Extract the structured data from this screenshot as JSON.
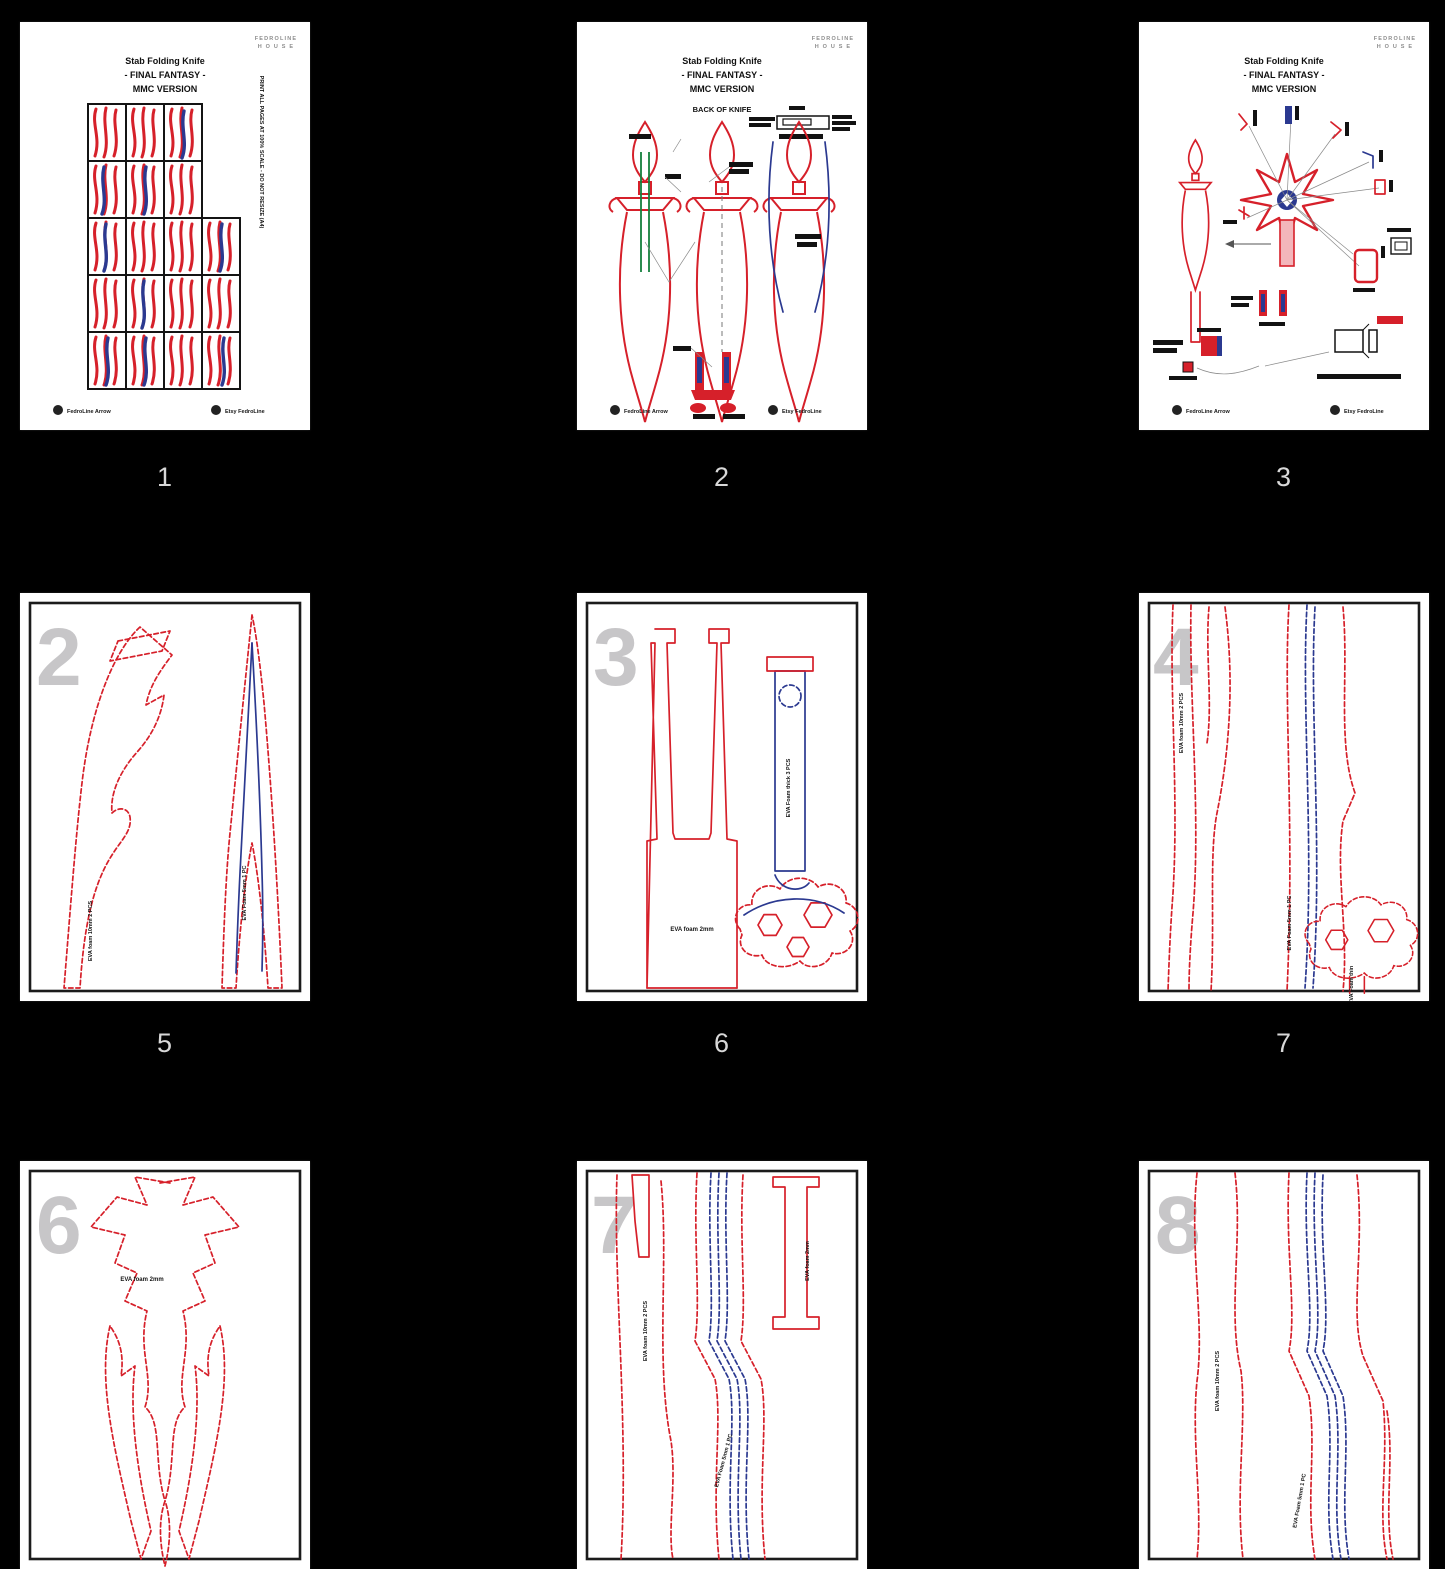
{
  "canvas": {
    "background": "#000000"
  },
  "colors": {
    "pattern_red": "#d6202a",
    "pattern_blue": "#2b3990",
    "pattern_green": "#15803d",
    "sheet_number_gray": "#c7c6c8",
    "thumb_label_gray": "#d8d8d8",
    "page_white": "#ffffff"
  },
  "brand": {
    "logo_line1": "FEDROLINE",
    "logo_line2": "H O U S E",
    "footer_left": "FedroLine Arrow",
    "footer_right": "Etsy FedroLine"
  },
  "title": {
    "line1": "Stab Folding Knife",
    "line2": "- FINAL FANTASY -",
    "line3": "MMC VERSION"
  },
  "page2": {
    "subtitle": "BACK OF KNIFE"
  },
  "page1": {
    "side_note": "PRINT ALL PAGES AT 100% SCALE - DO NOT RESIZE (A4)"
  },
  "materials": {
    "eva10": "EVA foam 10mm 2 PCS",
    "eva2": "EVA foam 2mm",
    "eva5": "EVA Foam 5mm 1 PC",
    "evath": "EVA Foam thick 3 PCS",
    "evathin": "EVA Foam thin"
  },
  "thumbnails": [
    {
      "label": "1",
      "sheet": ""
    },
    {
      "label": "2",
      "sheet": ""
    },
    {
      "label": "3",
      "sheet": ""
    },
    {
      "label": "5",
      "sheet": "2"
    },
    {
      "label": "6",
      "sheet": "3"
    },
    {
      "label": "7",
      "sheet": "4"
    },
    {
      "label": "",
      "sheet": "6"
    },
    {
      "label": "",
      "sheet": "7"
    },
    {
      "label": "",
      "sheet": "8"
    }
  ]
}
